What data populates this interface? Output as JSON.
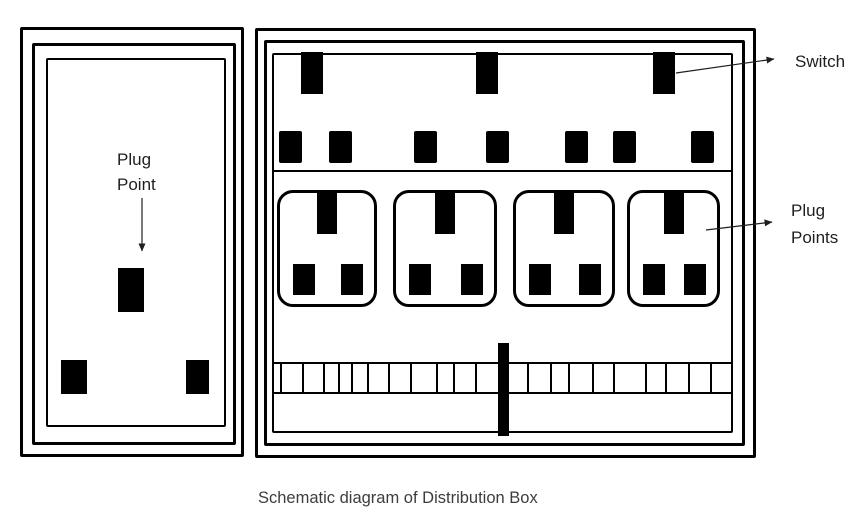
{
  "caption": "Schematic diagram of Distribution Box",
  "left_panel": {
    "label_line1": "Plug",
    "label_line2": "Point",
    "plug_pin_count": 3
  },
  "right_panel": {
    "switch_label": "Switch",
    "plug_points_label_line1": "Plug",
    "plug_points_label_line2": "Points",
    "switches_x": [
      301,
      476,
      653
    ],
    "fuses_x": [
      279,
      329,
      414,
      486,
      565,
      613,
      691
    ],
    "plug_units": [
      {
        "x": 277,
        "w": 100
      },
      {
        "x": 393,
        "w": 104
      },
      {
        "x": 513,
        "w": 102
      },
      {
        "x": 627,
        "w": 93
      }
    ],
    "terminal_ticks_x": [
      8,
      30,
      51,
      66,
      79,
      95,
      116,
      138,
      164,
      181,
      203,
      255,
      278,
      296,
      320,
      341,
      373,
      393,
      416,
      438
    ]
  },
  "colors": {
    "ink": "#000000",
    "label_text": "#1f1f1f",
    "caption_text": "#3d3d3d",
    "background": "#ffffff"
  }
}
